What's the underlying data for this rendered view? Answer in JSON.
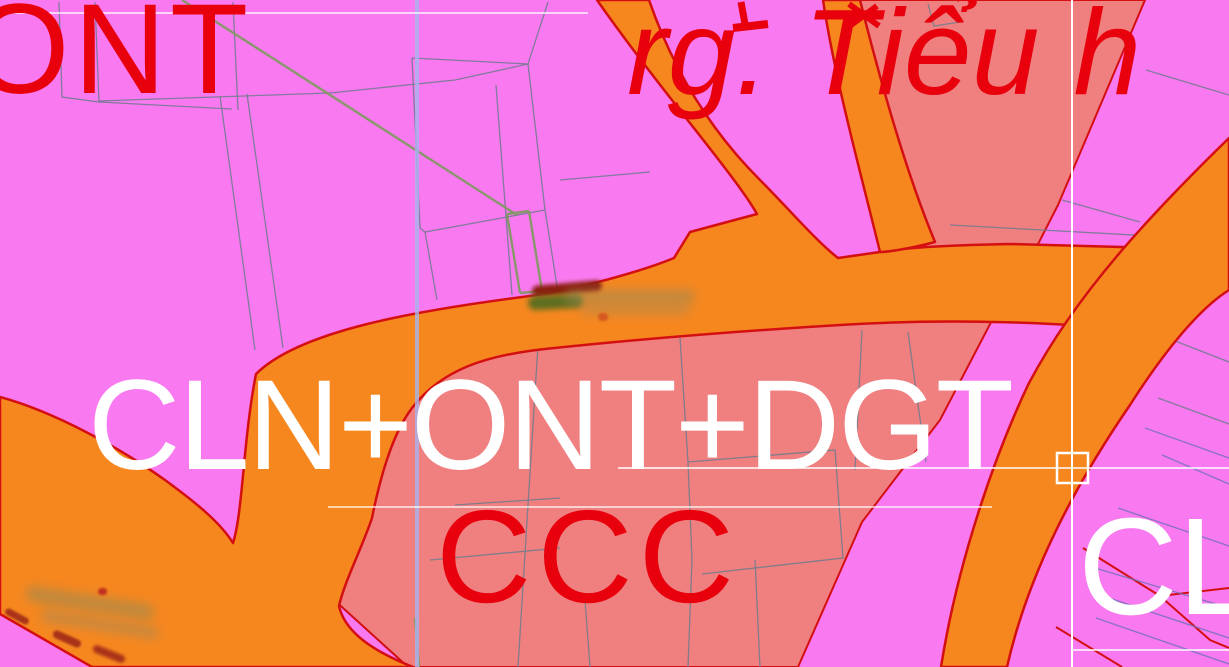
{
  "zone_labels": {
    "ont": "ONT",
    "school": "rg. Tiểu h",
    "mixed_zone": "CLN+ONT+DGT",
    "ccc": "CCC",
    "cl": "CL"
  },
  "colors": {
    "residential_pink": "#f97af0",
    "mixed_salmon": "#f08080",
    "road_orange": "#f6871f",
    "road_edge_red": "#d40f12",
    "label_red": "#e8000d",
    "label_white": "#ffffff",
    "parcel_gray": "#6e7b8e",
    "parcel_blue": "#7070b8",
    "grid_white": "#ffffff",
    "grid_blue": "#a8b4ee",
    "cadastral_green": "#7d9a5e"
  }
}
